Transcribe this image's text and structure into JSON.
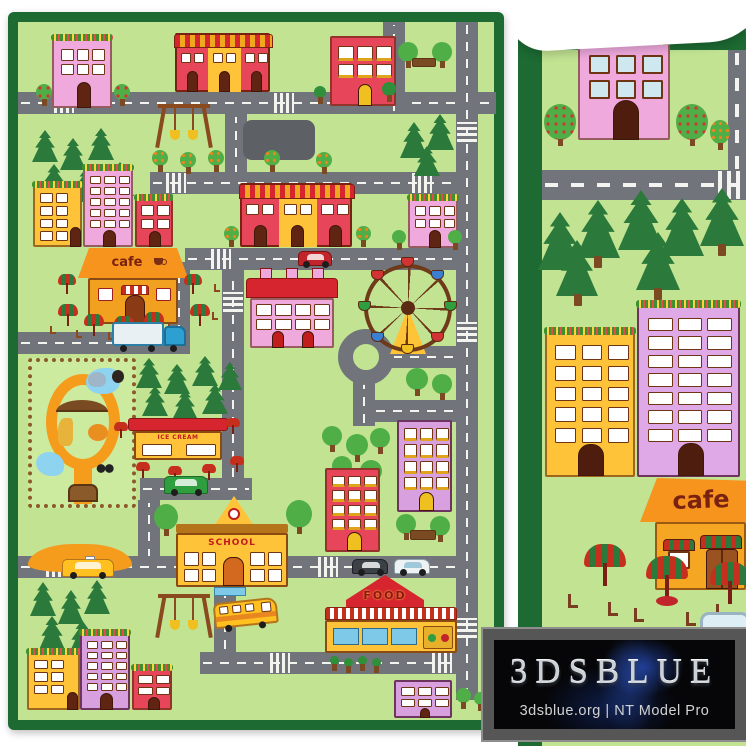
{
  "watermark": {
    "brand": "3DSBLUE",
    "tagline": "3dsblue.org | NT Model Pro"
  },
  "rug_labels": {
    "cafe": "cafe",
    "school": "SCHOOL",
    "food": "FOOD",
    "ice_cream": "ICE CREAM"
  },
  "detail_labels": {
    "cafe": "cafe"
  },
  "icons": {
    "cafe_sign_cup": "coffee-cup-icon"
  },
  "colors": {
    "border_green": "#1d6a33",
    "field_green": "#c2e492",
    "road_gray": "#71757b",
    "marking_white": "#f3f3ef",
    "pine_green": "#2b7a3c",
    "tree_green": "#4fae46",
    "trunk_brown": "#7c4a22",
    "building_yellow": "#ffc33a",
    "building_orange": "#f7941d",
    "building_pink": "#efa9dd",
    "building_lilac": "#d9a0e0",
    "building_red": "#e6455a",
    "roof_red": "#d6252e",
    "zoo_path_orange": "#f59c1c",
    "water_blue": "#8ed4f0",
    "umbrella_red": "#c62f1d",
    "umbrella_green": "#2b7a3c",
    "logo_frame_gray": "#565656",
    "logo_bg_black": "#060608",
    "logo_text_silver": "#ccd1d7"
  }
}
